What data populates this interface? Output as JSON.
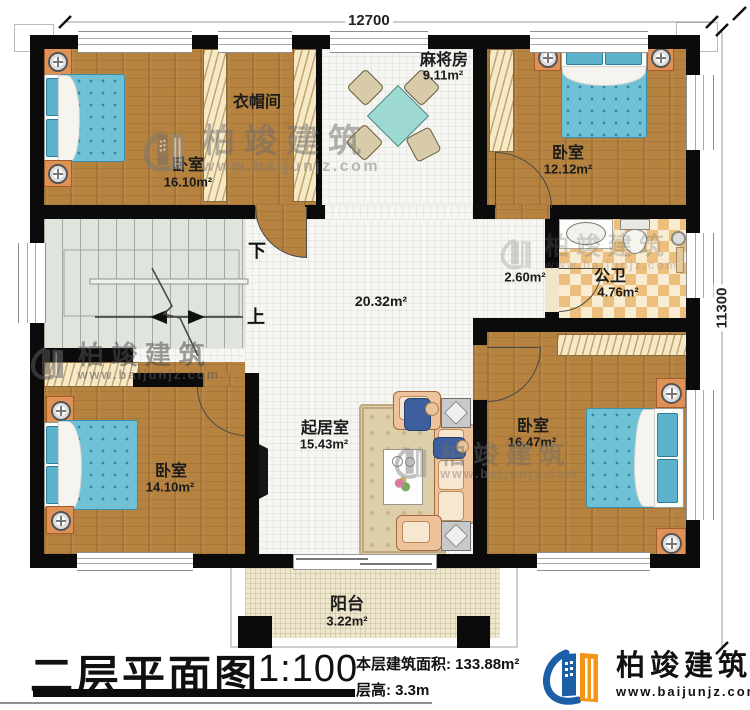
{
  "plan": {
    "dim_top": "12700",
    "dim_right": "11300",
    "rooms": {
      "bedroom_tl": {
        "name": "卧室",
        "area": "16.10m²"
      },
      "cloakroom": {
        "name": "衣帽间"
      },
      "mahjong": {
        "name": "麻将房",
        "area": "9.11m²"
      },
      "bedroom_tr": {
        "name": "卧室",
        "area": "12.12m²"
      },
      "hall": {
        "area": "20.32m²"
      },
      "corridor": {
        "area": "2.60m²"
      },
      "bathroom": {
        "name": "公卫",
        "area": "4.76m²"
      },
      "bedroom_bl": {
        "name": "卧室",
        "area": "14.10m²"
      },
      "living": {
        "name": "起居室",
        "area": "15.43m²"
      },
      "bedroom_br": {
        "name": "卧室",
        "area": "16.47m²"
      },
      "balcony": {
        "name": "阳台",
        "area": "3.22m²"
      }
    },
    "stairs": {
      "down": "下",
      "up": "上"
    }
  },
  "titleblock": {
    "title": "二层平面图",
    "scale": "1:100",
    "floor_area": "本层建筑面积: 133.88m²",
    "floor_height": "层高: 3.3m"
  },
  "brand": {
    "name": "柏竣建筑",
    "website": "www.baijunjz.com",
    "blue": "#1b5fa6",
    "orange": "#f39617"
  },
  "watermark": {
    "name": "柏竣建筑",
    "website": "www.baijunjz.com"
  }
}
